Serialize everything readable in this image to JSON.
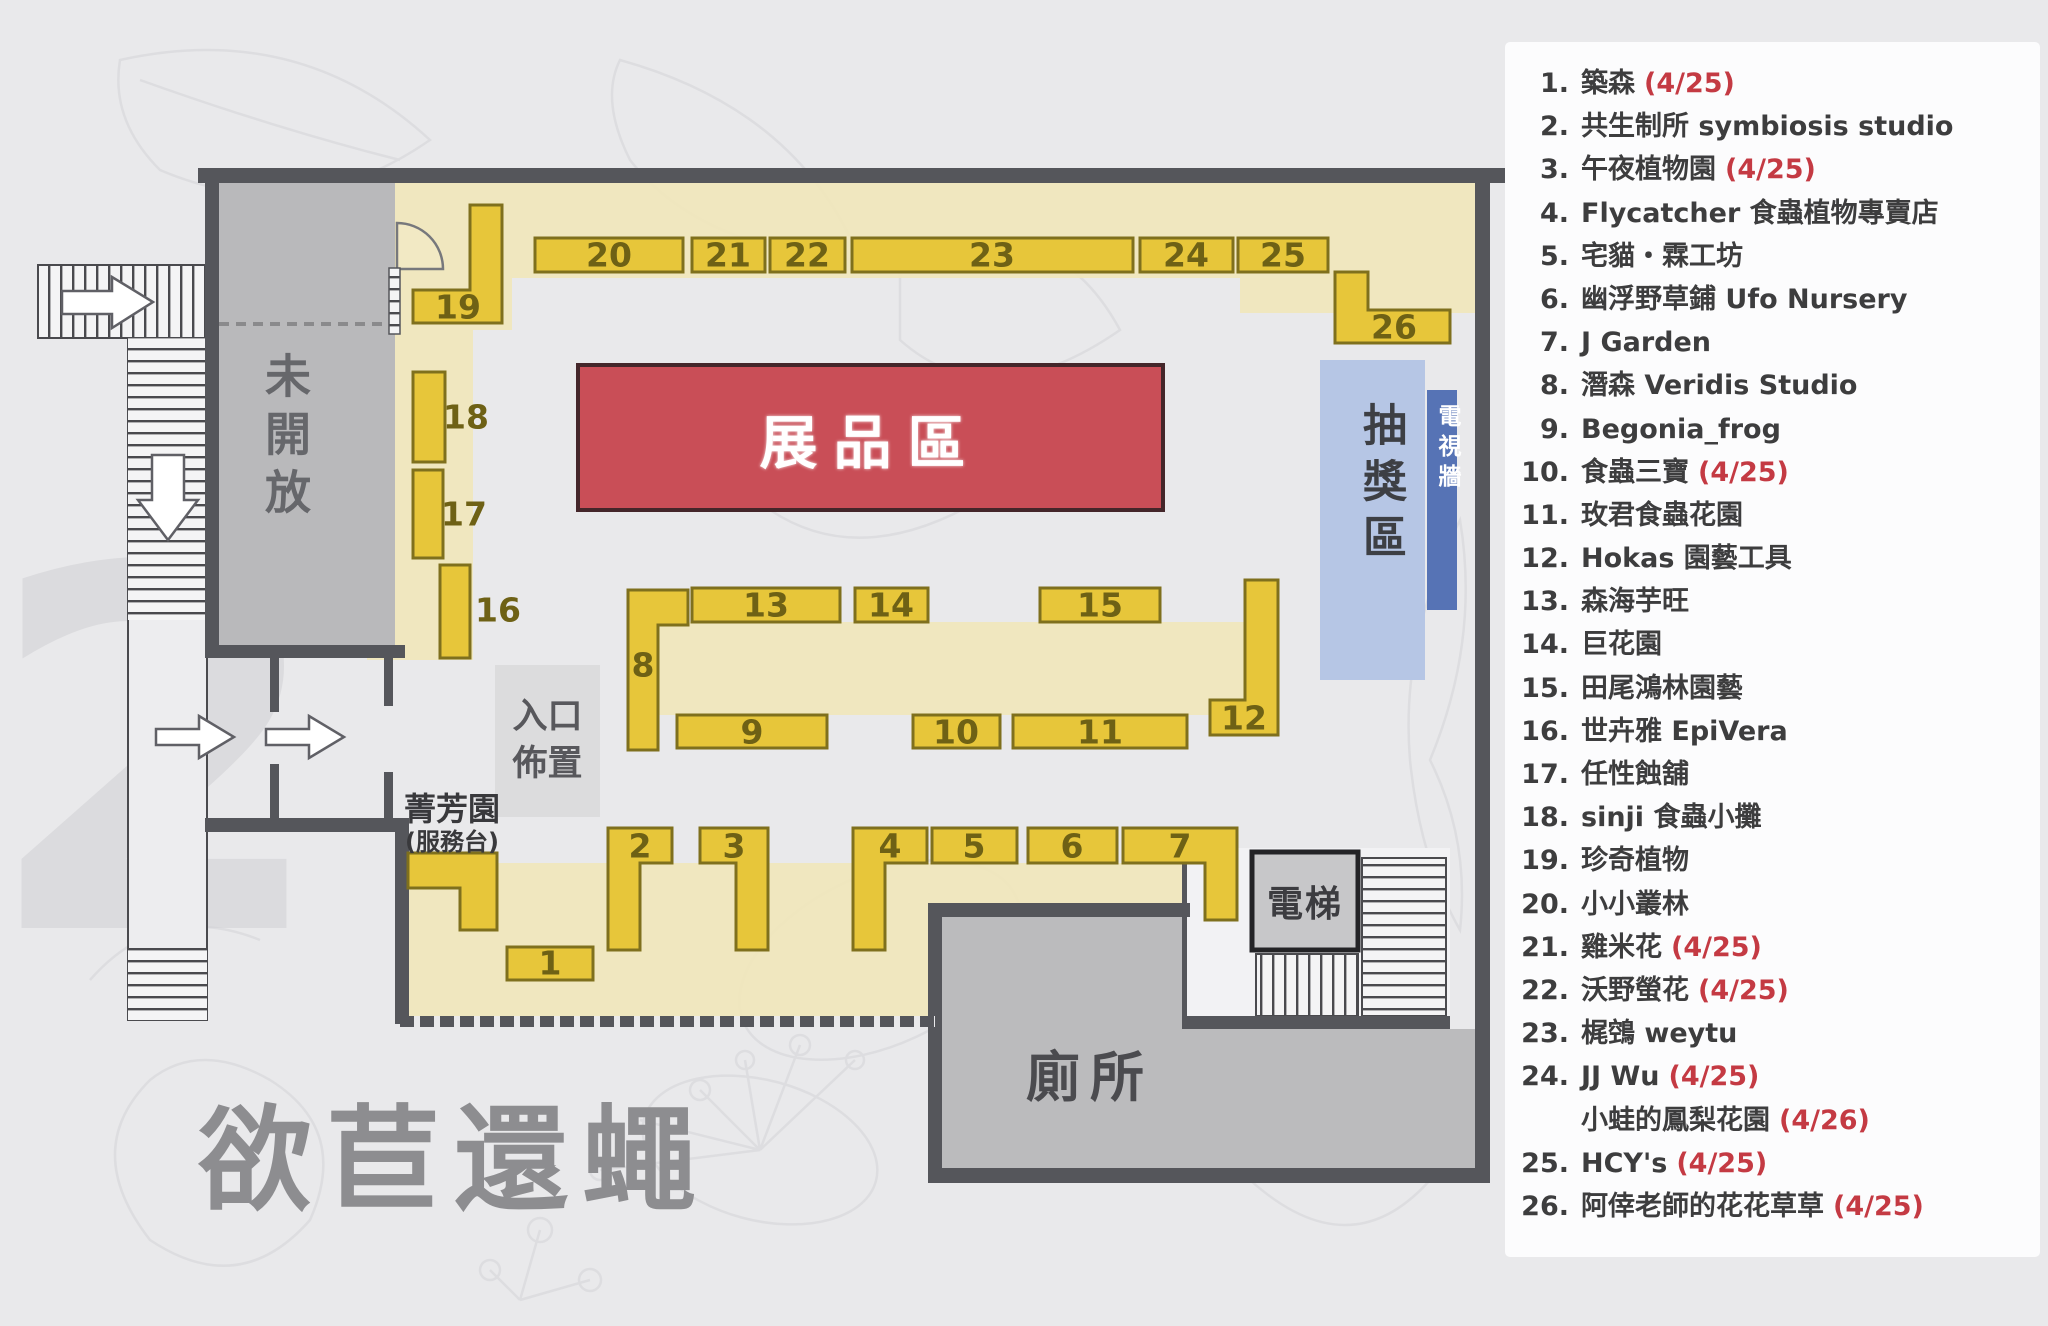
{
  "title": "欲苣還蠅",
  "watermark": "2",
  "map": {
    "areas": {
      "closed": "未開放",
      "exhibit": "展品區",
      "raffle": "抽獎區",
      "tv_wall": "電視牆",
      "entrance_line1": "入口",
      "entrance_line2": "佈置",
      "service_line1": "菁芳園",
      "service_line2": "(服務台)",
      "elevator": "電梯",
      "toilet": "廁所"
    },
    "booth_labels": [
      "1",
      "2",
      "3",
      "4",
      "5",
      "6",
      "7",
      "8",
      "9",
      "10",
      "11",
      "12",
      "13",
      "14",
      "15",
      "16",
      "17",
      "18",
      "19",
      "20",
      "21",
      "22",
      "23",
      "24",
      "25",
      "26"
    ],
    "colors": {
      "booth_fill": "#e7c63a",
      "booth_border": "#7f701d",
      "pale_band": "#f0e6bb",
      "exhibit_red": "#c94e57",
      "raffle_blue": "#b6c6e5",
      "tv_wall_blue": "#5673b5",
      "wall_gray": "#55565b"
    }
  },
  "legend": {
    "items": [
      {
        "num": "1.",
        "name": "築森",
        "date": "(4/25)"
      },
      {
        "num": "2.",
        "name": "共生制所 symbiosis studio",
        "date": ""
      },
      {
        "num": "3.",
        "name": "午夜植物園",
        "date": "(4/25)"
      },
      {
        "num": "4.",
        "name": "Flycatcher 食蟲植物專賣店",
        "date": ""
      },
      {
        "num": "5.",
        "name": "宅貓・霖工坊",
        "date": ""
      },
      {
        "num": "6.",
        "name": "幽浮野草鋪 Ufo Nursery",
        "date": ""
      },
      {
        "num": "7.",
        "name": "J Garden",
        "date": ""
      },
      {
        "num": "8.",
        "name": "潛森 Veridis Studio",
        "date": ""
      },
      {
        "num": "9.",
        "name": "Begonia_frog",
        "date": ""
      },
      {
        "num": "10.",
        "name": "食蟲三寶",
        "date": "(4/25)"
      },
      {
        "num": "11.",
        "name": "玫君食蟲花園",
        "date": ""
      },
      {
        "num": "12.",
        "name": "Hokas 園藝工具",
        "date": ""
      },
      {
        "num": "13.",
        "name": "森海芋旺",
        "date": ""
      },
      {
        "num": "14.",
        "name": "巨花園",
        "date": ""
      },
      {
        "num": "15.",
        "name": "田尾鴻林園藝",
        "date": ""
      },
      {
        "num": "16.",
        "name": "世卉雅 EpiVera",
        "date": ""
      },
      {
        "num": "17.",
        "name": "任性蝕舖",
        "date": ""
      },
      {
        "num": "18.",
        "name": "sinji 食蟲小攤",
        "date": ""
      },
      {
        "num": "19.",
        "name": "珍奇植物",
        "date": ""
      },
      {
        "num": "20.",
        "name": "小小叢林",
        "date": ""
      },
      {
        "num": "21.",
        "name": "雞米花",
        "date": "(4/25)"
      },
      {
        "num": "22.",
        "name": "沃野螢花",
        "date": "(4/25)"
      },
      {
        "num": "23.",
        "name": "梶鵼 weytu",
        "date": ""
      },
      {
        "num": "24.",
        "name": "JJ Wu",
        "date": "(4/25)"
      },
      {
        "num": "",
        "name": "小蛙的鳳梨花園",
        "date": "(4/26)"
      },
      {
        "num": "25.",
        "name": "HCY's",
        "date": "(4/25)"
      },
      {
        "num": "26.",
        "name": "阿倖老師的花花草草",
        "date": "(4/25)"
      }
    ]
  }
}
